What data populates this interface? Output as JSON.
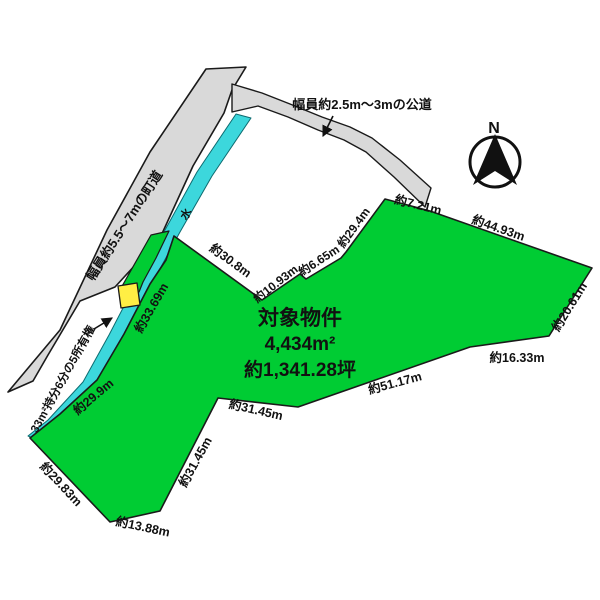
{
  "diagram": {
    "property": {
      "name": "対象物件",
      "area_sqm": "4,434m²",
      "area_tsubo": "約1,341.28坪"
    },
    "roads": {
      "town_road_label": "幅員約5.5〜7mの町道",
      "public_road_label": "幅員約2.5m〜3mの公道"
    },
    "water": {
      "label": "水"
    },
    "ownership_note": "33m²持分6分の5所有権",
    "compass": {
      "north": "N"
    },
    "colors": {
      "parcel_green": "#00cc33",
      "water_cyan": "#3cd7dc",
      "road_gray": "#d9d9d9",
      "ownership_yellow": "#ffee44",
      "outline": "#1a1a1a"
    },
    "dimensions": {
      "top_edge": "約7.21m",
      "upper_right_edge": "約44.93m",
      "right_edge": "約20.61m",
      "lower_right_edge": "約16.33m",
      "bottom_right_edge": "約51.17m",
      "notch_edge": "約31.45m",
      "notch_steep_edge": "約31.45m",
      "bottom_left_edge": "約29.83m",
      "bottom_edge": "約13.88m",
      "water_frontage_lower": "約29.9m",
      "water_frontage_upper": "約33.69m",
      "upper_left_edge": "約30.8m",
      "step_edge_a": "約10.93m",
      "step_edge_b": "約6.65m",
      "step_edge_c": "約29.4m"
    }
  }
}
